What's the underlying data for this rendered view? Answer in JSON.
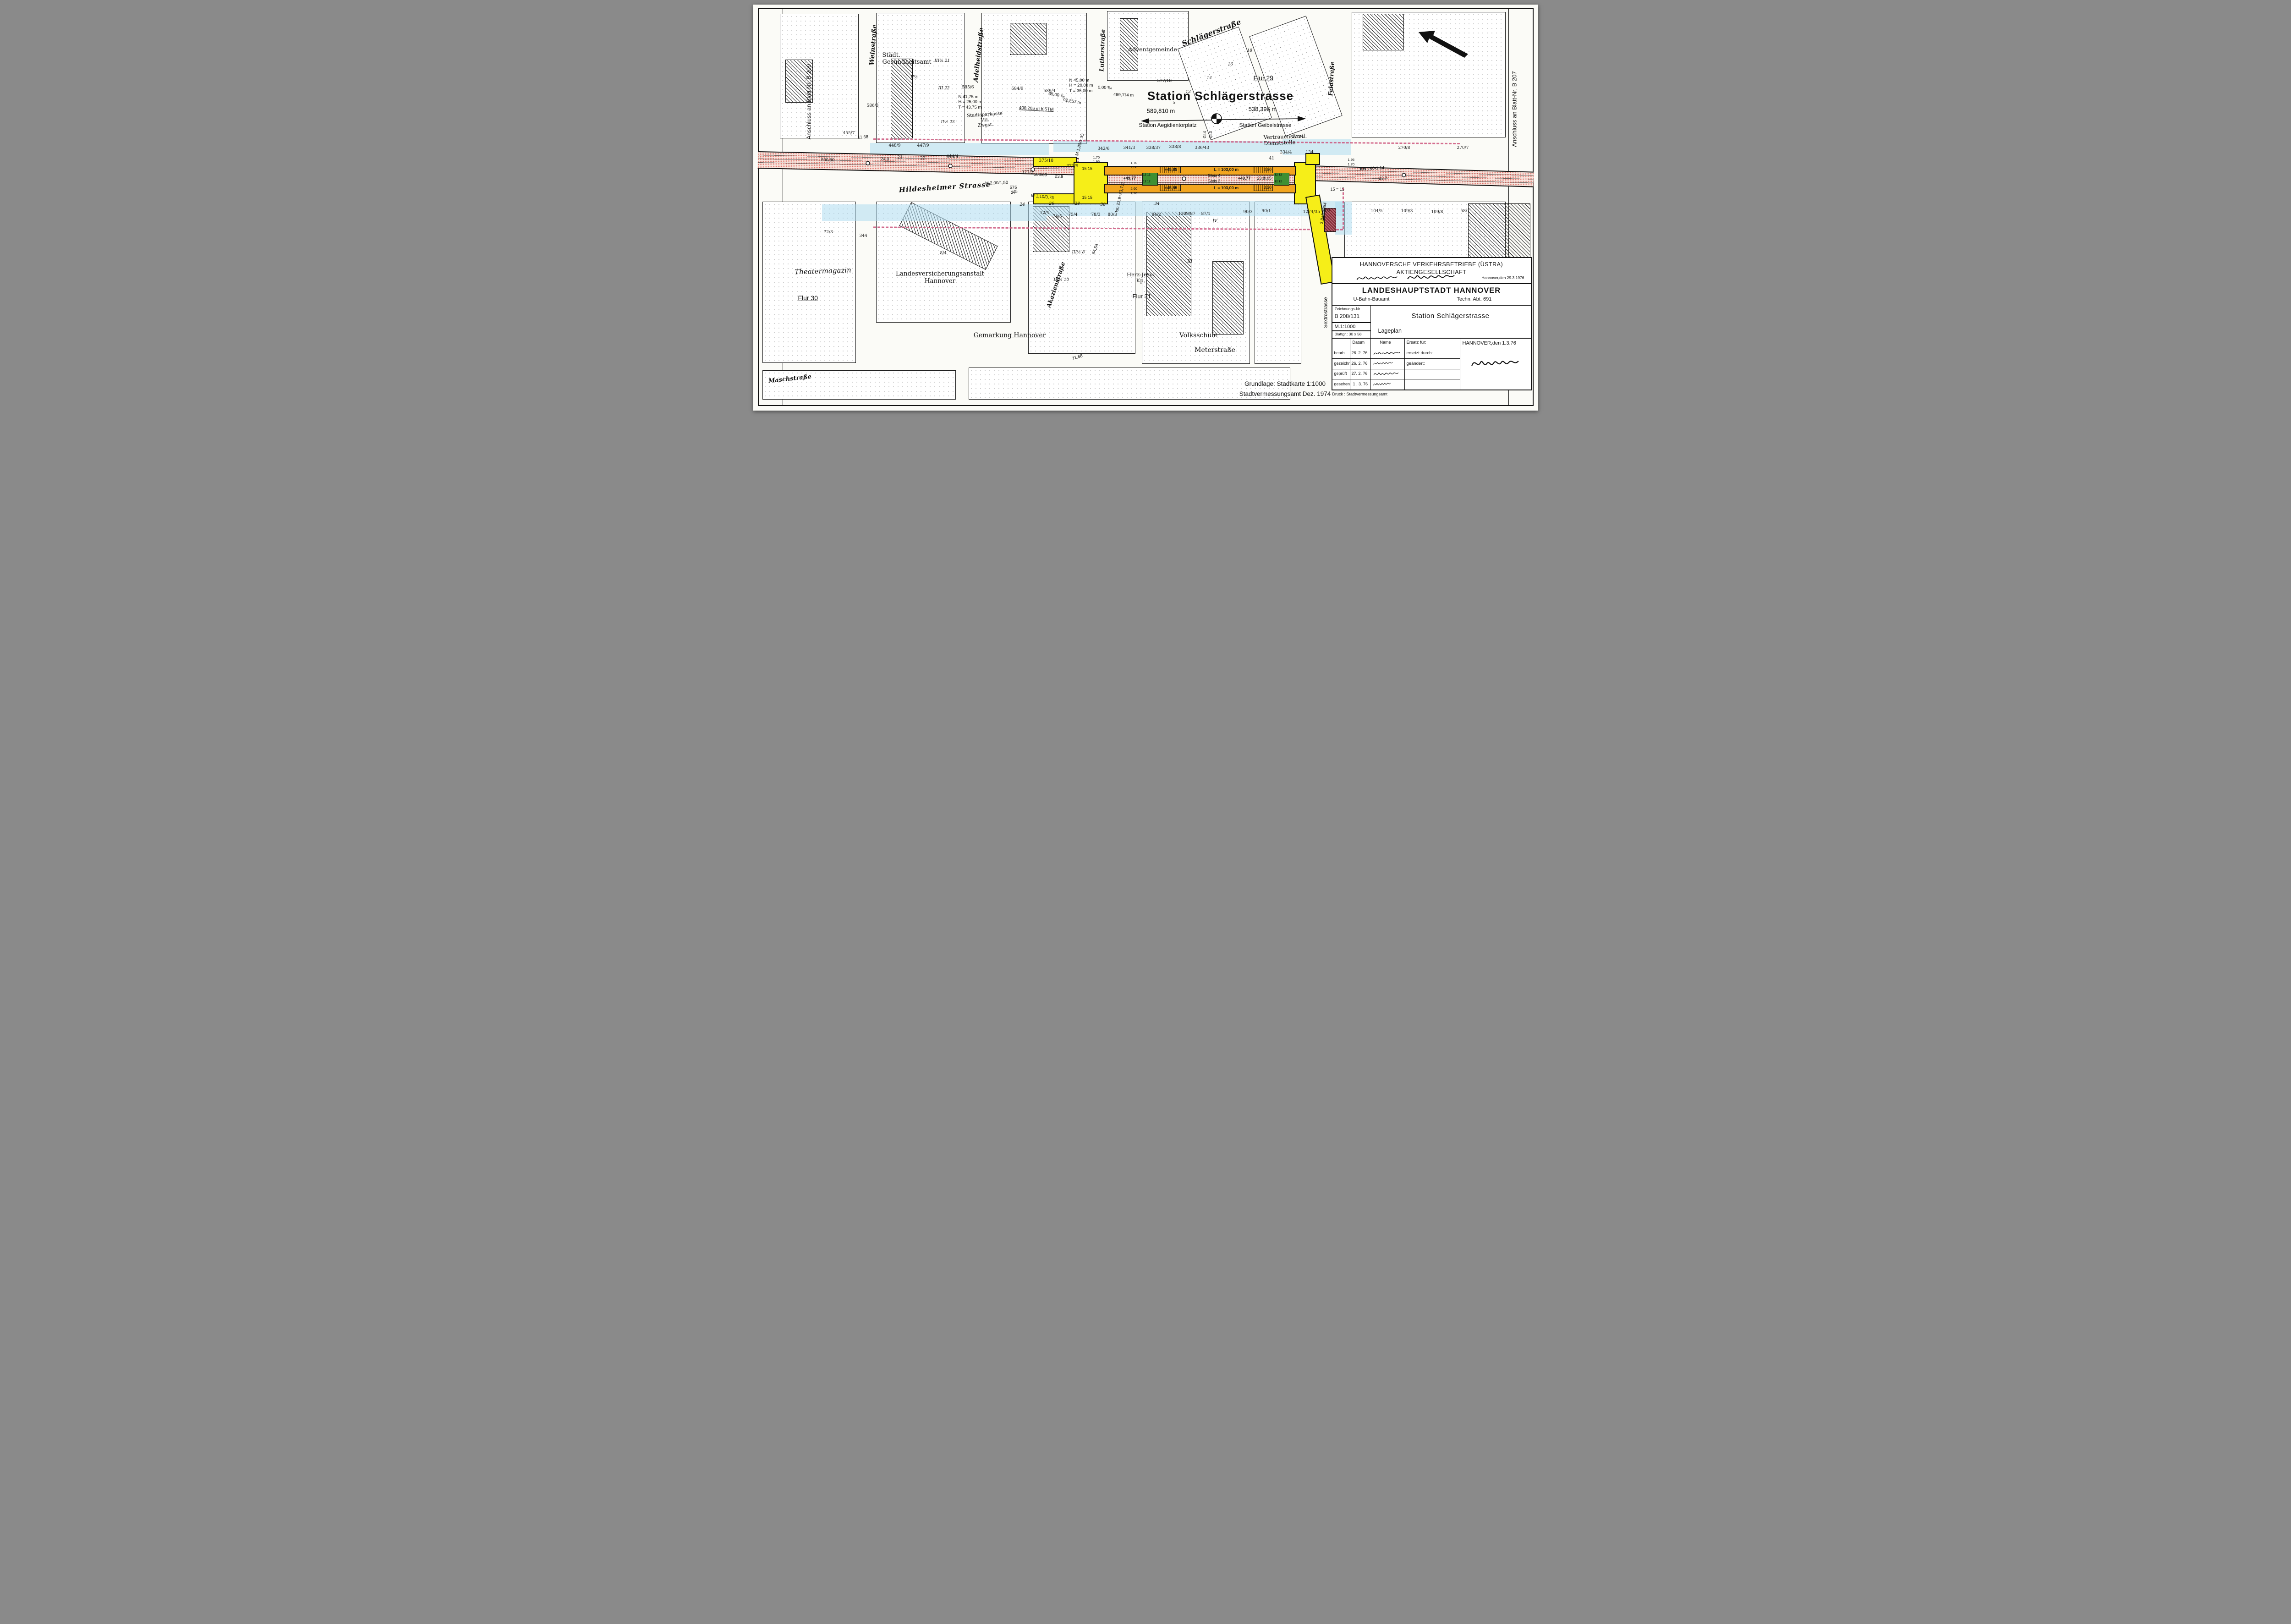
{
  "colors": {
    "paper": "#fbfbf7",
    "ink": "#111111",
    "track_red": "#d9544a",
    "station_yellow": "#f6ee18",
    "platform_orange": "#f2a51f",
    "stair_green": "#3f8f33",
    "tunnel_blue": "#aeddf0",
    "boundary_magenta": "#cd557d"
  },
  "edges": {
    "left": "Anschluss an Blatt Nr. B 209",
    "right": "Anschluss an Blatt-Nr. B 207"
  },
  "header": {
    "title": "Station Schlägerstrasse",
    "left_chainage": "589,810 m",
    "left_station": "Station Aegidientorplatz",
    "right_chainage": "538,396 m",
    "right_station": "Station Geibelstrasse",
    "gl4": "Gl.4",
    "gl3": "Gl.3"
  },
  "streets": {
    "wein": "Weinstraße",
    "adelheid": "Adelheidstraße",
    "luther": "Lutherstraße",
    "schlaeger": "Schlägerstraße",
    "feld": "Feldstraße",
    "hildesheimer": "Hildesheimer Strasse",
    "akazien": "Akazienstraße",
    "sextro": "Sextrostrasse",
    "masch": "Maschstraße",
    "meter": "Meterstraße"
  },
  "places": {
    "gesundheitsamt": "Städt.\nGesundheitsamt",
    "adventgemeinde": "Adventgemeinde",
    "theatermagazin": "Theatermagazin",
    "lva": "Landesversicherungsanstalt\nHannover",
    "volksschule": "Volksschule",
    "herzjesu": "Herz-Jesu-\nKp.",
    "vertrauen": "Vertrauensärztl.\nDienststelle",
    "sparkasse": "Stadtsparkasse\nVII.\nZwgst.",
    "gemarkung": "Gemarkung Hannover",
    "flur29": "Flur 29",
    "flur30": "Flur 30",
    "flur31": "Flur 31"
  },
  "station": {
    "plus": "+45,85",
    "len": "L = 103,00 m",
    "gleis4": "Gleis 4",
    "gleis3": "Gleis 3",
    "k4977": "+49,77",
    "g12": "12  12",
    "w350": "3,50",
    "w405": "4,05",
    "d260": "2,60",
    "d170": "1,70",
    "n195": "1,95",
    "n15": "15  15",
    "n15r": "15 = 15",
    "ew": "EW 760-1:14",
    "v238": "23,8",
    "v237": "23,7"
  },
  "measures": {
    "r500_80": "500/80",
    "r24": "24,0",
    "r500_60": "500/60",
    "v239": "23,9",
    "m200": "M 2,00/1,50",
    "f575": "575\n27",
    "m110": "M 1,10/0,75",
    "m180": "M 1,80/1,35",
    "n45": "N  45,00 m\nH = 20,00 m\nT = 35,00 m",
    "n41": "N  41,75 m\nH = 25,00 m\nT = 43,75 m",
    "b400": "400,205 m b.STM",
    "m92857": "92,857 m",
    "p35": "35,00 ‰",
    "p0": "0,00 ‰",
    "m499": "499,114 m",
    "km": "km 23,9+83,711",
    "km2": "3,8+90,854",
    "d5454": "54,54",
    "d1168": "11,68"
  },
  "parcels": [
    "455/7",
    "586/3",
    "585/6",
    "584/9",
    "589/4",
    "577/18",
    "5",
    "448/9",
    "447/9",
    "444/4",
    "21",
    "23",
    "25",
    "377/2",
    "375/18",
    "371/9",
    "342/6",
    "341/3",
    "338/37",
    "338/8",
    "336/43",
    "334/4",
    "41",
    "576/4",
    "134",
    "270/8",
    "270/7",
    "344",
    "72/3",
    "8/4",
    "72/4",
    "74/5",
    "75/4",
    "78/3",
    "80/3",
    "84/2",
    "1309/87",
    "87/1",
    "90/3",
    "90/1",
    "1274/35",
    "94/3",
    "104/5",
    "109/3",
    "109/8",
    "58/1",
    "24",
    "26",
    "28",
    "30",
    "34",
    "II½",
    "III½ 21",
    "III 22",
    "II½ 23",
    "III½ 8",
    "III½ 10",
    "III",
    "IV",
    "12",
    "14",
    "16",
    "18"
  ],
  "title_block": {
    "company1": "HANNOVERSCHE VERKEHRSBETRIEBE (ÜSTRA)",
    "company2": "AKTIENGESELLSCHAFT",
    "date_right": "Hannover,den 29.3.1976",
    "city": "LANDESHAUPTSTADT  HANNOVER",
    "office": "U-Bahn-Bauamt",
    "dept": "Techn. Abt.  691",
    "no_label": "Zeichnungs-Nr.",
    "no": "B  208/131",
    "scale": "M.1:1000",
    "sheet": "Blattgr.: 30 x 58",
    "title": "Station  Schlägerstrasse",
    "subtitle": "Lageplan",
    "col_datum": "Datum",
    "col_name": "Name",
    "ersatz": "Ersatz für:",
    "ersetzt": "ersetzt durch:",
    "geaendert": "geändert:",
    "r1l": "bearb.",
    "r1d": "26. 2. 76",
    "r2l": "gezeichn.",
    "r2d": "26. 2. 76",
    "r3l": "geprüft",
    "r3d": "27. 2. 76",
    "r4l": "gesehen",
    "r4d": "1 . 3. 76",
    "place_date": "HANNOVER,den  1.3.76",
    "druck": "Druck : Stadtvermessungsamt"
  },
  "footer": {
    "source1": "Grundlage: Stadtkarte 1:1000",
    "source2": "Stadtvermessungsamt  Dez. 1974"
  }
}
